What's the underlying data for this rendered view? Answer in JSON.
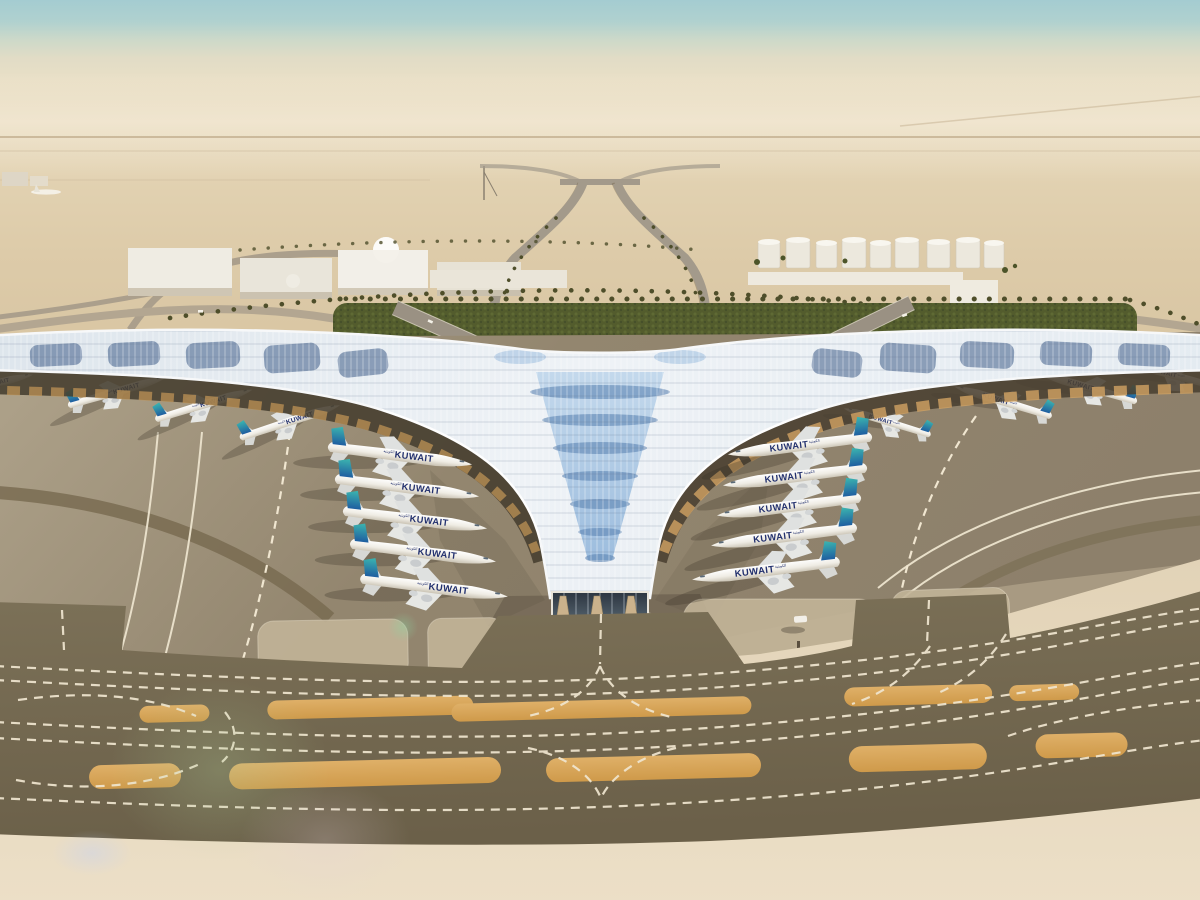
{
  "meta": {
    "title": "Aerial rendering of Kuwait International Airport new trefoil terminal",
    "scene_type": "architectural-rendering",
    "view": "aerial, looking north over terminal, aprons and taxiways"
  },
  "airline": {
    "name": "Kuwait Airways",
    "wordmark": "KUWAIT",
    "arabic_script": "الكويتية",
    "tail_color_top": "#3cb6b0",
    "tail_color_bottom": "#1f5ea0",
    "title_color": "#22306e"
  },
  "terminal": {
    "roof_style": "trefoil photovoltaic canopy",
    "roof_silver": "#e7edf2",
    "roof_blue": "#8fb4da",
    "facade_color": "#cbb28c"
  },
  "palette": {
    "sky_top": "#a4ccd1",
    "sky_horizon": "#e9dfc6",
    "desert": "#ddcba9",
    "apron_light": "#b0a48c",
    "apron_dark": "#8a7d69",
    "taxiway": "#756a52",
    "sand_island": "#d9a85c",
    "marking_white": "#f0e6d0",
    "hedge_green": "#535c2d",
    "sand_foreground": "#e7dac0"
  },
  "scene": {
    "counts": {
      "widebody_aircraft_center": 10,
      "narrowbody_aircraft_wings": 8,
      "fuel_tanks": 9,
      "warehouses": 6,
      "domes": 2,
      "approach_roads": 2
    },
    "ground_vehicle": {
      "color": "#f2efe8",
      "x": 800,
      "y": 619
    },
    "aircraft": [
      {
        "cx": -12,
        "cy": 386,
        "deg": -13,
        "s": 0.5,
        "flip": false,
        "layer": "under"
      },
      {
        "cx": 116,
        "cy": 393,
        "deg": -16,
        "s": 0.56,
        "flip": false,
        "layer": "under"
      },
      {
        "cx": 203,
        "cy": 406,
        "deg": -17,
        "s": 0.56,
        "flip": false,
        "layer": "under"
      },
      {
        "cx": 289,
        "cy": 423,
        "deg": -18,
        "s": 0.58,
        "flip": false,
        "layer": "under"
      },
      {
        "cx": 888,
        "cy": 423,
        "deg": 17,
        "s": 0.5,
        "flip": true,
        "layer": "under"
      },
      {
        "cx": 1004,
        "cy": 403,
        "deg": 17,
        "s": 0.56,
        "flip": true,
        "layer": "under"
      },
      {
        "cx": 1089,
        "cy": 389,
        "deg": 16,
        "s": 0.56,
        "flip": true,
        "layer": "under"
      },
      {
        "cx": 1172,
        "cy": 376,
        "deg": 15,
        "s": 0.54,
        "flip": true,
        "layer": "under"
      },
      {
        "cx": 398,
        "cy": 457,
        "deg": 7,
        "s": 0.8,
        "flip": false,
        "layer": "front"
      },
      {
        "cx": 405,
        "cy": 489,
        "deg": 7,
        "s": 0.8,
        "flip": false,
        "layer": "front"
      },
      {
        "cx": 413,
        "cy": 521,
        "deg": 7,
        "s": 0.8,
        "flip": false,
        "layer": "front"
      },
      {
        "cx": 421,
        "cy": 554,
        "deg": 7,
        "s": 0.81,
        "flip": false,
        "layer": "front"
      },
      {
        "cx": 432,
        "cy": 589,
        "deg": 7,
        "s": 0.82,
        "flip": false,
        "layer": "front"
      },
      {
        "cx": 802,
        "cy": 447,
        "deg": -7,
        "s": 0.8,
        "flip": true,
        "layer": "front"
      },
      {
        "cx": 797,
        "cy": 478,
        "deg": -7,
        "s": 0.8,
        "flip": true,
        "layer": "front"
      },
      {
        "cx": 791,
        "cy": 508,
        "deg": -7,
        "s": 0.8,
        "flip": true,
        "layer": "front"
      },
      {
        "cx": 786,
        "cy": 538,
        "deg": -7,
        "s": 0.81,
        "flip": true,
        "layer": "front"
      },
      {
        "cx": 768,
        "cy": 572,
        "deg": -7,
        "s": 0.82,
        "flip": true,
        "layer": "front"
      }
    ]
  }
}
